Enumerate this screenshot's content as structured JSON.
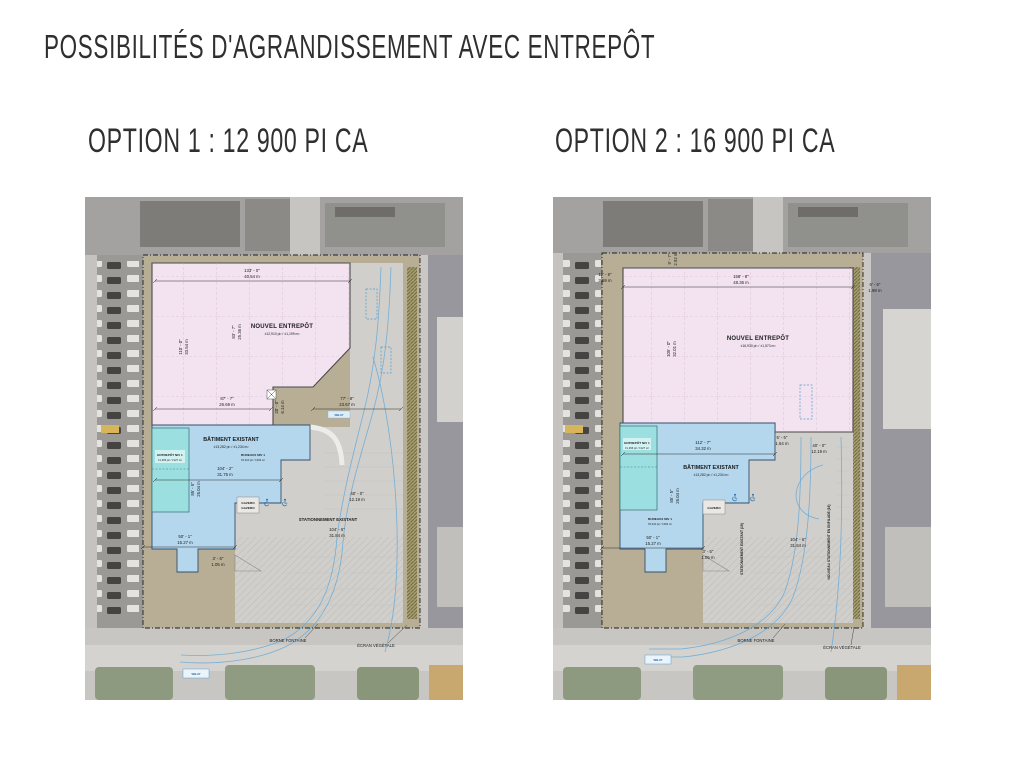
{
  "slide": {
    "title": "POSSIBILITÉS D'AGRANDISSEMENT AVEC ENTREPÔT"
  },
  "option1": {
    "heading": "OPTION 1 : 12 900 PI CA",
    "labels": {
      "nouvel_entrepot": "NOUVEL ENTREPÔT",
      "nouvel_entrepot_area": "±12,910 pi² / ±1,199 m²",
      "batiment": "BÂTIMENT EXISTANT",
      "batiment_area": "±13,282 pi² / ±1,234 m²",
      "entrepot_niv1": "ENTREPÔT NIV 1",
      "entrepot_niv1_area": "±1,366 pi² / ±127 m²",
      "bureaux_niv1": "BUREAUX NIV 1",
      "bureaux_niv1_area": "±5,310 pi² / ±493 m²",
      "gazebo_a": "GAZEBO",
      "gazebo_b": "GAZEBO",
      "stationnement": "STATIONNEMENT EXISTANT",
      "borne_fontaine": "BORNE FONTAINE",
      "ecran_vegetale": "ÉCRAN VÉGÉTALE",
      "truck_road": "WB-67",
      "truck_drive": "WB-67"
    },
    "dims": {
      "top_ft": "133' - 0\"",
      "top_m": "40.54 m",
      "left_ft": "110' - 0\"",
      "left_m": "33.54 m",
      "mid_ft": "83' - 7\"",
      "mid_m": "25.36 m",
      "south_ft": "87' - 7\"",
      "south_m": "26.69 m",
      "notch_ft": "20' - 0\"",
      "notch_m": "6.14 m",
      "drive_ft": "77' - 8\"",
      "drive_m": "23.67 m",
      "bat_w_ft": "104' - 2\"",
      "bat_w_m": "31.75 m",
      "bat_h_ft": "85' - 5\"",
      "bat_h_m": "26.04 m",
      "west_ft": "50' - 1\"",
      "west_m": "15.27 m",
      "small_ft": "3' - 5\"",
      "small_m": "1.05 m",
      "park_w_ft": "40' - 0\"",
      "park_w_m": "12.19 m",
      "park_l_ft": "104' - 6\"",
      "park_l_m": "31.84 m"
    }
  },
  "option2": {
    "heading": "OPTION 2 : 16 900 PI CA",
    "labels": {
      "nouvel_entrepot": "NOUVEL ENTREPÔT",
      "nouvel_entrepot_area": "±16,930 pi² / ±1,573 m²",
      "batiment": "BÂTIMENT EXISTANT",
      "batiment_area": "±13,282 pi² / ±1,234 m²",
      "entrepot_niv1": "ENTREPÔT NIV 1",
      "entrepot_niv1_area": "±1,366 pi² / ±127 m²",
      "bureaux_niv1": "BUREAUX NIV 1",
      "bureaux_niv1_area": "±5,310 pi² / ±493 m²",
      "gazebo": "GAZEBO",
      "stationnement_existant": "STATIONNEMENT EXISTANT (19)",
      "nouveau_stationnement": "NOUVEAU STATIONNEMENT EN ENFILADE (16)",
      "borne_fontaine": "BORNE FONTAINE",
      "ecran_vegetale": "ÉCRAN VÉGÉTALE",
      "truck_road": "WB-67"
    },
    "dims": {
      "top_ft": "158' - 8\"",
      "top_m": "48.36 m",
      "top_left_ft": "11' - 9\"",
      "top_left_m": "3.59 m",
      "top_mid_ft": "9' - 7\"",
      "top_mid_m": "2.92 m",
      "top_right_ft": "6' - 6\"",
      "top_right_m": "1.98 m",
      "left_ft": "105' - 0\"",
      "left_m": "32.01 m",
      "bat_w_ft": "112' - 7\"",
      "bat_w_m": "34.32 m",
      "gap_ft": "5' - 5\"",
      "gap_m": "1.64 m",
      "park_w_ft": "40' - 0\"",
      "park_w_m": "12.19 m",
      "bat_h_ft": "85' - 5\"",
      "bat_h_m": "26.04 m",
      "west_ft": "50' - 1\"",
      "west_m": "15.27 m",
      "small_ft": "3' - 5\"",
      "small_m": "1.05 m",
      "park_l_ft": "104' - 6\"",
      "park_l_m": "31.84 m"
    }
  }
}
